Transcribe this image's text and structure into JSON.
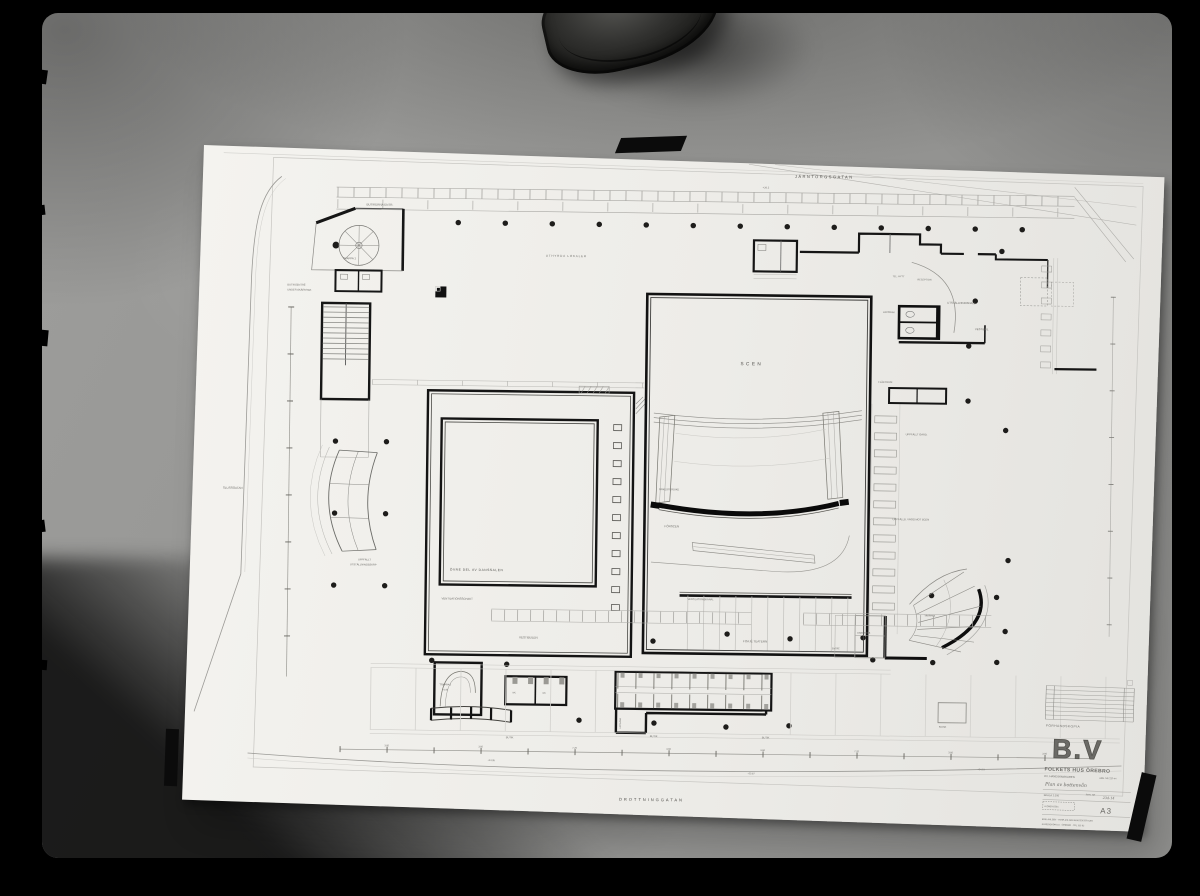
{
  "photo": {
    "colors": {
      "film_border": "#000000",
      "surface": "#949492",
      "paper": "#f1f0ec",
      "ink": "#1a1a1a",
      "pencil": "#6b6a66",
      "tape": "#0b0b0b"
    },
    "objects": {
      "leather_item": "dark leather strap end over top edge",
      "tape_pieces": [
        "top-center",
        "bottom-left",
        "right-edge"
      ]
    }
  },
  "plan": {
    "labels": {
      "street_top": "JÄRNTORGSGATAN",
      "street_bottom": "DROTTNINGGATAN",
      "street_left": "SLUSSGATAN",
      "level_top": "+26.2",
      "level_a": "+24.05",
      "level_b": "+23.87",
      "level_c": "+24.15",
      "shops": "BUTIKERNA ENTR.",
      "rented": "UTHYRDA LOKALER",
      "stair1": "TRAPPA 1",
      "entry_left_1": "BUTIKSENTRÉ",
      "entry_left_2": "UNDER SKÄRMTAK",
      "display_1": "UPPFÄLLT",
      "display_2": "UTSTÄLLNINGSSKÅP",
      "hall": "ÖVRE DEL AV DANSSALEN",
      "vent_shaft": "VENTILATIONSSCHAKT",
      "stage": "SCEN",
      "orchestra": "ORKESTERDIKE",
      "forestage": "FÖRSCEN",
      "vent_duct": "VENTILATIONSKANAL",
      "wardrobe_flap": "UPPFÄLLT GARD.",
      "wall_note": "UPPFÄLLB. VÄGG MOT SCEN",
      "fan_room": "FLÄKTRUM",
      "phone": "TEL. HYTT",
      "reception": "RECEPTION",
      "exhibition": "UTSTÄLLNINGSHALL",
      "vestibule_r": "VESTIBUL",
      "cloak": "KAPPRUM",
      "vestibule_c": "VESTIBULEN",
      "foyer": "FOAJÉ TEATERN",
      "stair2": "TRAPPA 2",
      "level_stair": "+1.94",
      "wc": "WC",
      "upgang": "UPPGÅNG",
      "shop": "BUTIK",
      "kiosk": "KIOSK",
      "cloak2": "GARDEROB",
      "entry_r": "ENTRÉ",
      "stair3": "TRAPPA 3"
    },
    "dimensions": [
      "3.60",
      "3.60",
      "7.20",
      "3.60",
      "3.60",
      "7.20",
      "3.60",
      "3.60"
    ]
  },
  "title_block": {
    "stamp": "FÖRHANDSKOPIA",
    "logo": "B.V",
    "project": "FOLKETS HUS ÖREBRO",
    "block": "KV. HANDSKMAKAREN",
    "job_no": "ARB. NR 237-44",
    "sheet_title": "Plan av bottenvån",
    "scale": "SKALA 1:100",
    "drawing_no_label": "RITN. NR",
    "drawing_no": "234-14",
    "revision": "A  OMBYGGN.",
    "format": "A3",
    "firm1": "ERIK AHLSÉN · TORE AHLSÉN  ARKITEKTER SAR",
    "firm2": "KUNGSGATAN 10 · ÖREBRO · TEL 103 62"
  }
}
